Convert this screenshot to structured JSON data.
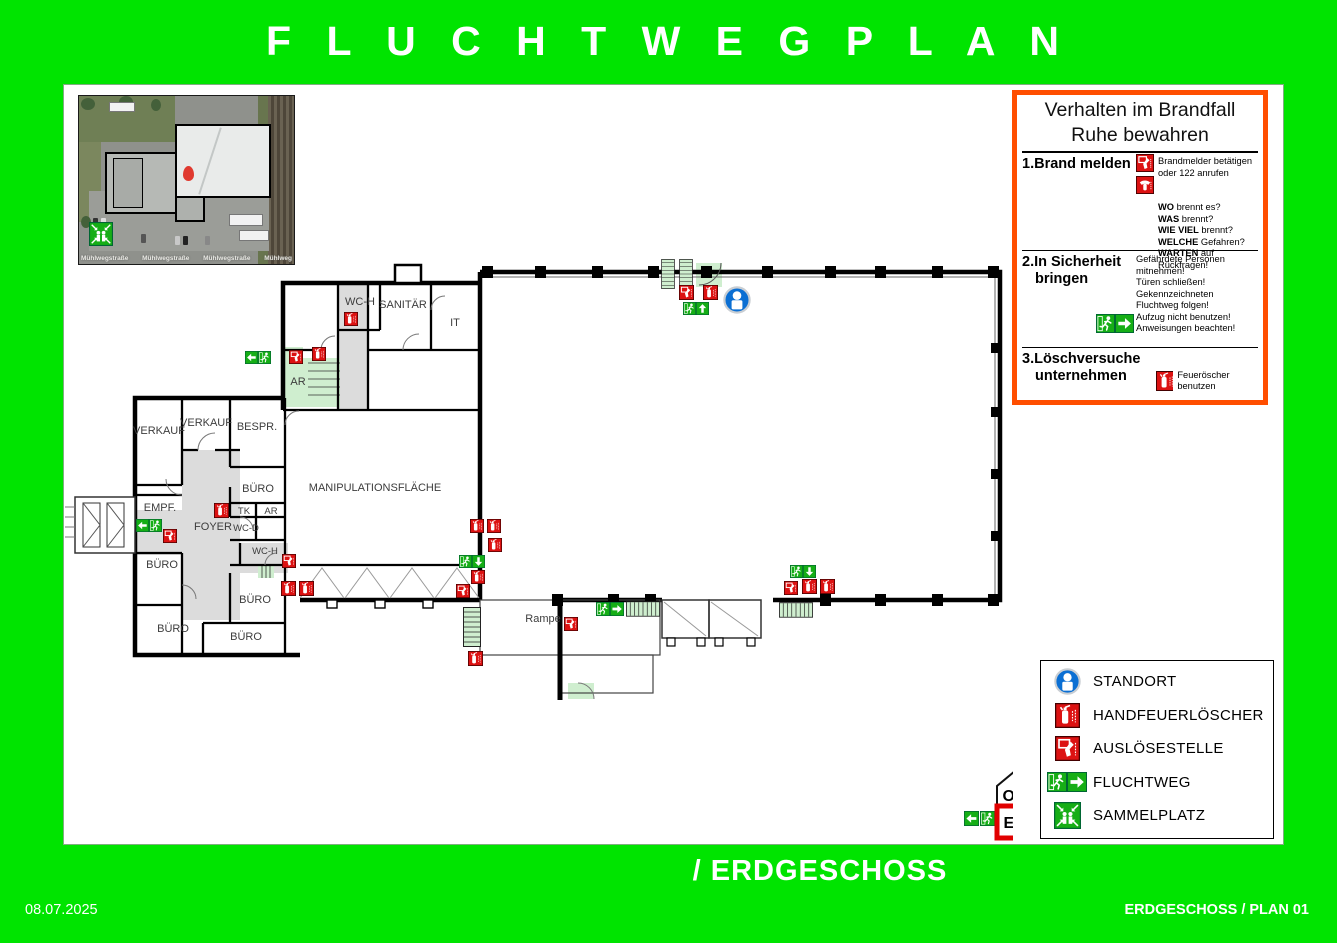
{
  "page": {
    "title": "F L U C H T W E G P L A N",
    "floor_title": "/ ERDGESCHOSS",
    "date": "08.07.2025",
    "plan_ref": "ERDGESCHOSS / PLAN 01"
  },
  "colors": {
    "background_green": "#00e400",
    "panel_orange": "#ff4e00",
    "signal_red": "#dc1212",
    "safety_green": "#16ae16",
    "stair_green": "#cfeecf",
    "standort_blue": "#0b6fd3"
  },
  "aerial": {
    "streets": [
      "Mühlwegstraße",
      "Mühlwegstraße",
      "Mühlwegstraße",
      "Mühlweg"
    ]
  },
  "instructions": {
    "title": "Verhalten im Brandfall",
    "subtitle": "Ruhe bewahren",
    "step1": {
      "num": "1.",
      "label": "Brand melden",
      "icon_text": [
        "Brandmelder betätigen",
        "oder 122 anrufen"
      ],
      "questions": [
        {
          "b": "WO",
          "r": " brennt es?"
        },
        {
          "b": "WAS",
          "r": " brennt?"
        },
        {
          "b": "WIE VIEL",
          "r": " brennt?"
        },
        {
          "b": "WELCHE",
          "r": " Gefahren?"
        },
        {
          "b": "WARTEN",
          "r": " auf Rückfragen!"
        }
      ]
    },
    "step2": {
      "num": "2.",
      "label_line1": "In Sicherheit",
      "label_line2": "bringen",
      "lines": [
        "Gefährdete Personen",
        "mitnehmen!",
        "Türen schließen!",
        "Gekennzeichneten",
        "Fluchtweg folgen!"
      ],
      "lines_with_icon": [
        "Aufzug nicht benutzen!",
        "Anweisungen beachten!"
      ]
    },
    "step3": {
      "num": "3.",
      "label_line1": "Löschversuche",
      "label_line2": "unternehmen",
      "icon_text": "Feueröscher benutzen"
    }
  },
  "legend": [
    {
      "icon": "standort-icon",
      "label": "STANDORT"
    },
    {
      "icon": "extinguisher-icon",
      "label": "HANDFEUERLÖSCHER"
    },
    {
      "icon": "alarm-icon",
      "label": "AUSLÖSESTELLE"
    },
    {
      "icon": "escape-route-icon",
      "label": "FLUCHTWEG"
    },
    {
      "icon": "assembly-point-icon",
      "label": "SAMMELPLATZ"
    }
  ],
  "floor_indicator": {
    "upper": "OG",
    "current": "EG"
  },
  "plan": {
    "rooms": {
      "wc_h_top": "WC-H",
      "sanitaer": "SANITÄR",
      "it": "IT",
      "ar_top": "AR",
      "verkauf_1": "VERKAUF",
      "verkauf_2": "VERKAUF",
      "bespr": "BESPR.",
      "empf": "EMPF.",
      "buero_1": "BÜRO",
      "tk": "TK",
      "ar_mid": "AR",
      "wc_d": "WC-D",
      "wc_h_mid": "WC-H",
      "foyer": "FOYER",
      "manipulation": "MANIPULATIONSFLÄCHE",
      "buero_2": "BÜRO",
      "buero_3": "BÜRO",
      "buero_4": "BÜRO",
      "buero_5": "BÜRO",
      "rampe": "Rampe"
    }
  }
}
